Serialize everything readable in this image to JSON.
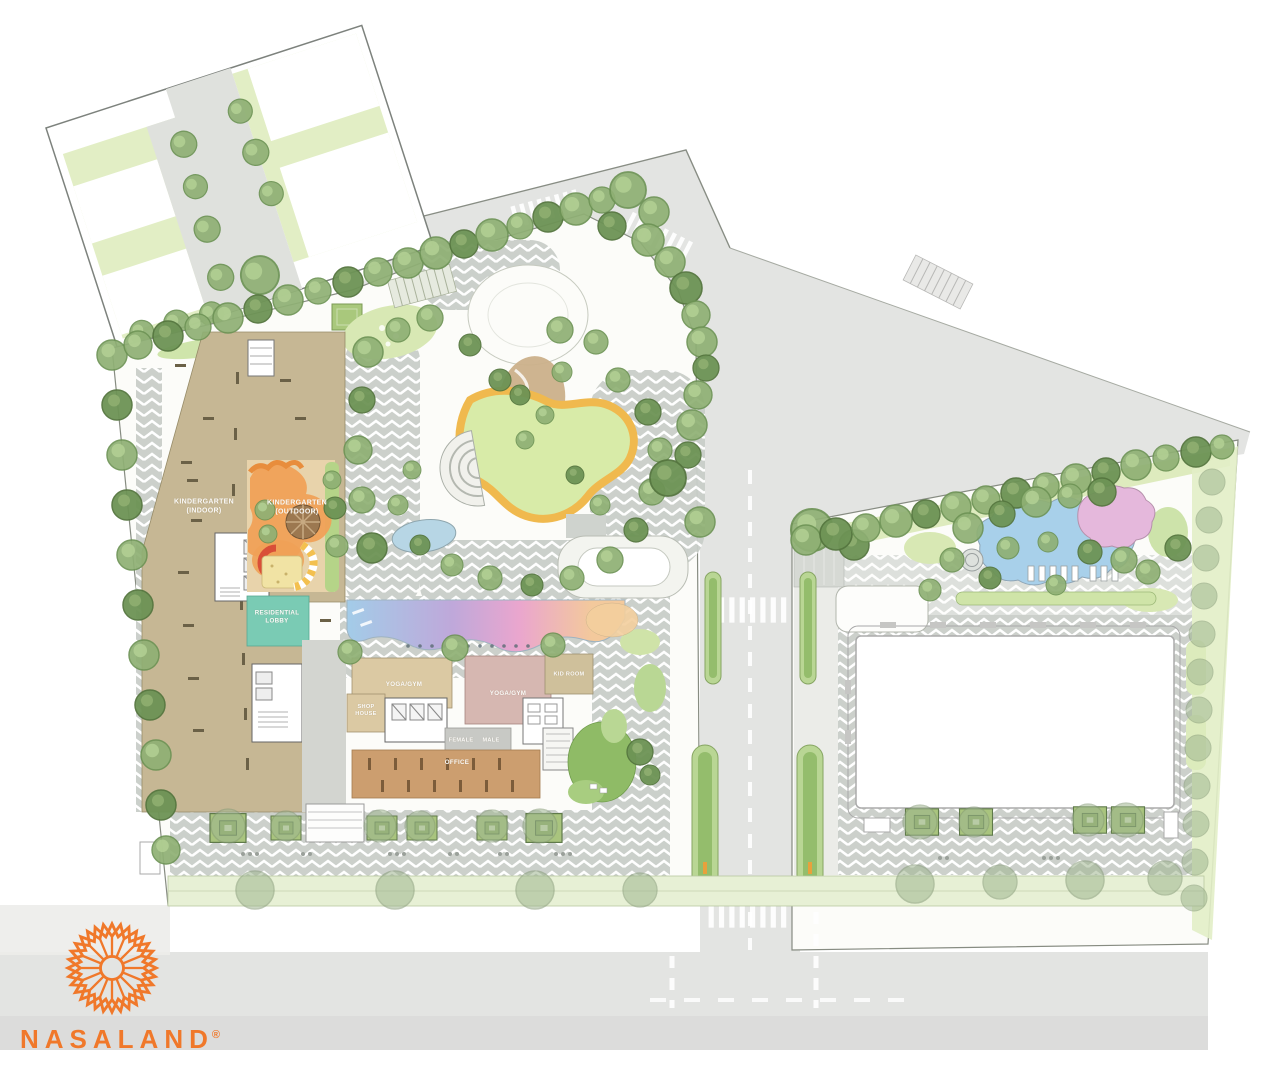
{
  "logo": {
    "brand": "NASALAND",
    "registered_mark": "®"
  },
  "plan": {
    "areas": {
      "kindergarten_indoor": {
        "line1": "KINDERGARTEN",
        "line2": "(INDOOR)"
      },
      "kindergarten_outdoor": {
        "line1": "KINDERGARTEN",
        "line2": "(OUTDOOR)"
      },
      "residential_lobby": {
        "line1": "RESIDENTIAL",
        "line2": "LOBBY"
      },
      "yoga_gym_west": {
        "label": "YOGA/GYM"
      },
      "yoga_gym_east": {
        "label": "YOGA/GYM"
      },
      "kid_room": {
        "label": "KID ROOM"
      },
      "shop_house": {
        "line1": "SHOP",
        "line2": "HOUSE"
      },
      "female_changing": {
        "label": "FEMALE"
      },
      "male_changing": {
        "label": "MALE"
      },
      "office": {
        "label": "OFFICE"
      }
    }
  },
  "colors": {
    "brand_orange": "#F0782A",
    "building_tan": "#C6B794",
    "office_brown": "#CC9E6F",
    "yoga_gym_west_tan": "#DBC9A3",
    "yoga_gym_east_pink": "#D6B7B1",
    "kid_room_tan": "#CFC09B",
    "residential_lobby_teal": "#7ACBB4",
    "playground_orange": "#F0A157",
    "pool_gradient": [
      "#A3CCE8",
      "#BFA8DA",
      "#EAA6CE",
      "#F3C99C"
    ],
    "lawn_green": "#E2EEC5",
    "tree_green": "#8FB074",
    "track_orange": "#F0B94E",
    "road_gray": "#E3E4E2"
  }
}
